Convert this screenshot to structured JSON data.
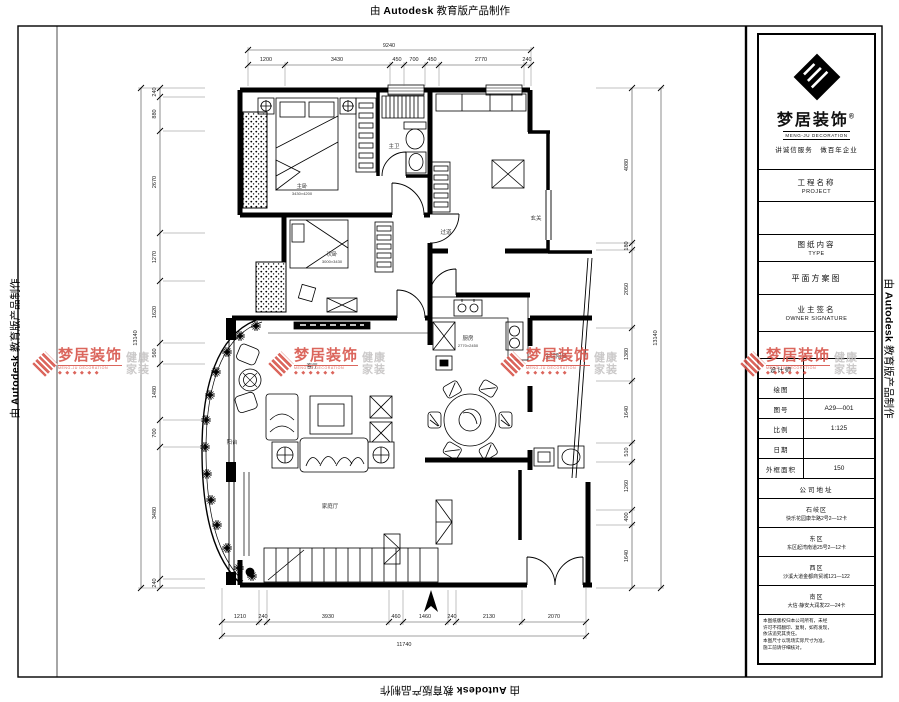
{
  "page": {
    "stamp_prefix": "由 ",
    "stamp_brand": "Autodesk",
    "stamp_suffix": " 教育版产品制作"
  },
  "title_block": {
    "brand_name": "梦居装饰",
    "brand_reg": "®",
    "brand_en": "MENG-JU DECORATION",
    "tagline": "讲诚信服务　做百年企业",
    "project_label": "工程名称",
    "project_label_en": "PROJECT",
    "type_label": "图纸内容",
    "type_label_en": "TYPE",
    "type_value": "平面方案图",
    "owner_label": "业主签名",
    "owner_label_en": "OWNER SIGNATURE",
    "fields": [
      {
        "label": "设计师",
        "value": ""
      },
      {
        "label": "绘图",
        "value": ""
      },
      {
        "label": "图号",
        "value": "A29—001"
      },
      {
        "label": "比例",
        "value": "1:125"
      },
      {
        "label": "日期",
        "value": ""
      },
      {
        "label": "外框面积",
        "value": "150"
      }
    ],
    "address_header": "公司地址",
    "addresses": [
      {
        "region": "石岐区",
        "line": "快乐花园康华路2号2—12卡"
      },
      {
        "region": "东区",
        "line": "东区起湾南道25号2—12卡"
      },
      {
        "region": "西区",
        "line": "沙溪大道金都商贸城121—122"
      },
      {
        "region": "南区",
        "line": "大信·静安大润发22—24卡"
      }
    ],
    "notes": [
      "本图纸版权归本公司所有，未经",
      "许可不得翻印、复制，如有发现，",
      "依法追究其责任。",
      "本图尺寸以现场实际尺寸为准，",
      "施工前请仔细核对。"
    ]
  },
  "watermark": {
    "name": "梦居装饰",
    "sub": "MENG-JU DECORATION",
    "dots": "◆◆◆◆◆◆",
    "right1": "健康",
    "right2": "家装",
    "color_red": "#d8564c",
    "color_gray": "#c6c4c4"
  },
  "plan": {
    "rooms": [
      {
        "name": "主卧",
        "sub": "3430×4200"
      },
      {
        "name": "次卧",
        "sub": "3000×3430"
      },
      {
        "name": "主卫",
        "sub": ""
      },
      {
        "name": "过道",
        "sub": ""
      },
      {
        "name": "玄关",
        "sub": ""
      },
      {
        "name": "客厅",
        "sub": ""
      },
      {
        "name": "厨房",
        "sub": "2770×2450"
      },
      {
        "name": "生活阳台",
        "sub": ""
      },
      {
        "name": "阳台",
        "sub": ""
      },
      {
        "name": "家庭厅",
        "sub": ""
      }
    ],
    "dims": {
      "top": {
        "total": "9240",
        "segments": [
          "1200",
          "3430",
          "450",
          "700",
          "450",
          "2770",
          "240"
        ]
      },
      "bottom": {
        "total": "11740",
        "segments": [
          "1210",
          "240",
          "3930",
          "460",
          "1460",
          "240",
          "2130",
          "2070"
        ]
      },
      "left": {
        "total": "13140",
        "segments": [
          "240",
          "880",
          "2670",
          "1270",
          "1620",
          "560",
          "1480",
          "700",
          "3480",
          "240"
        ]
      },
      "right": {
        "total": "13140",
        "segments": [
          "4080",
          "180",
          "2050",
          "1380",
          "1640",
          "510",
          "1260",
          "400",
          "1640"
        ]
      }
    }
  }
}
